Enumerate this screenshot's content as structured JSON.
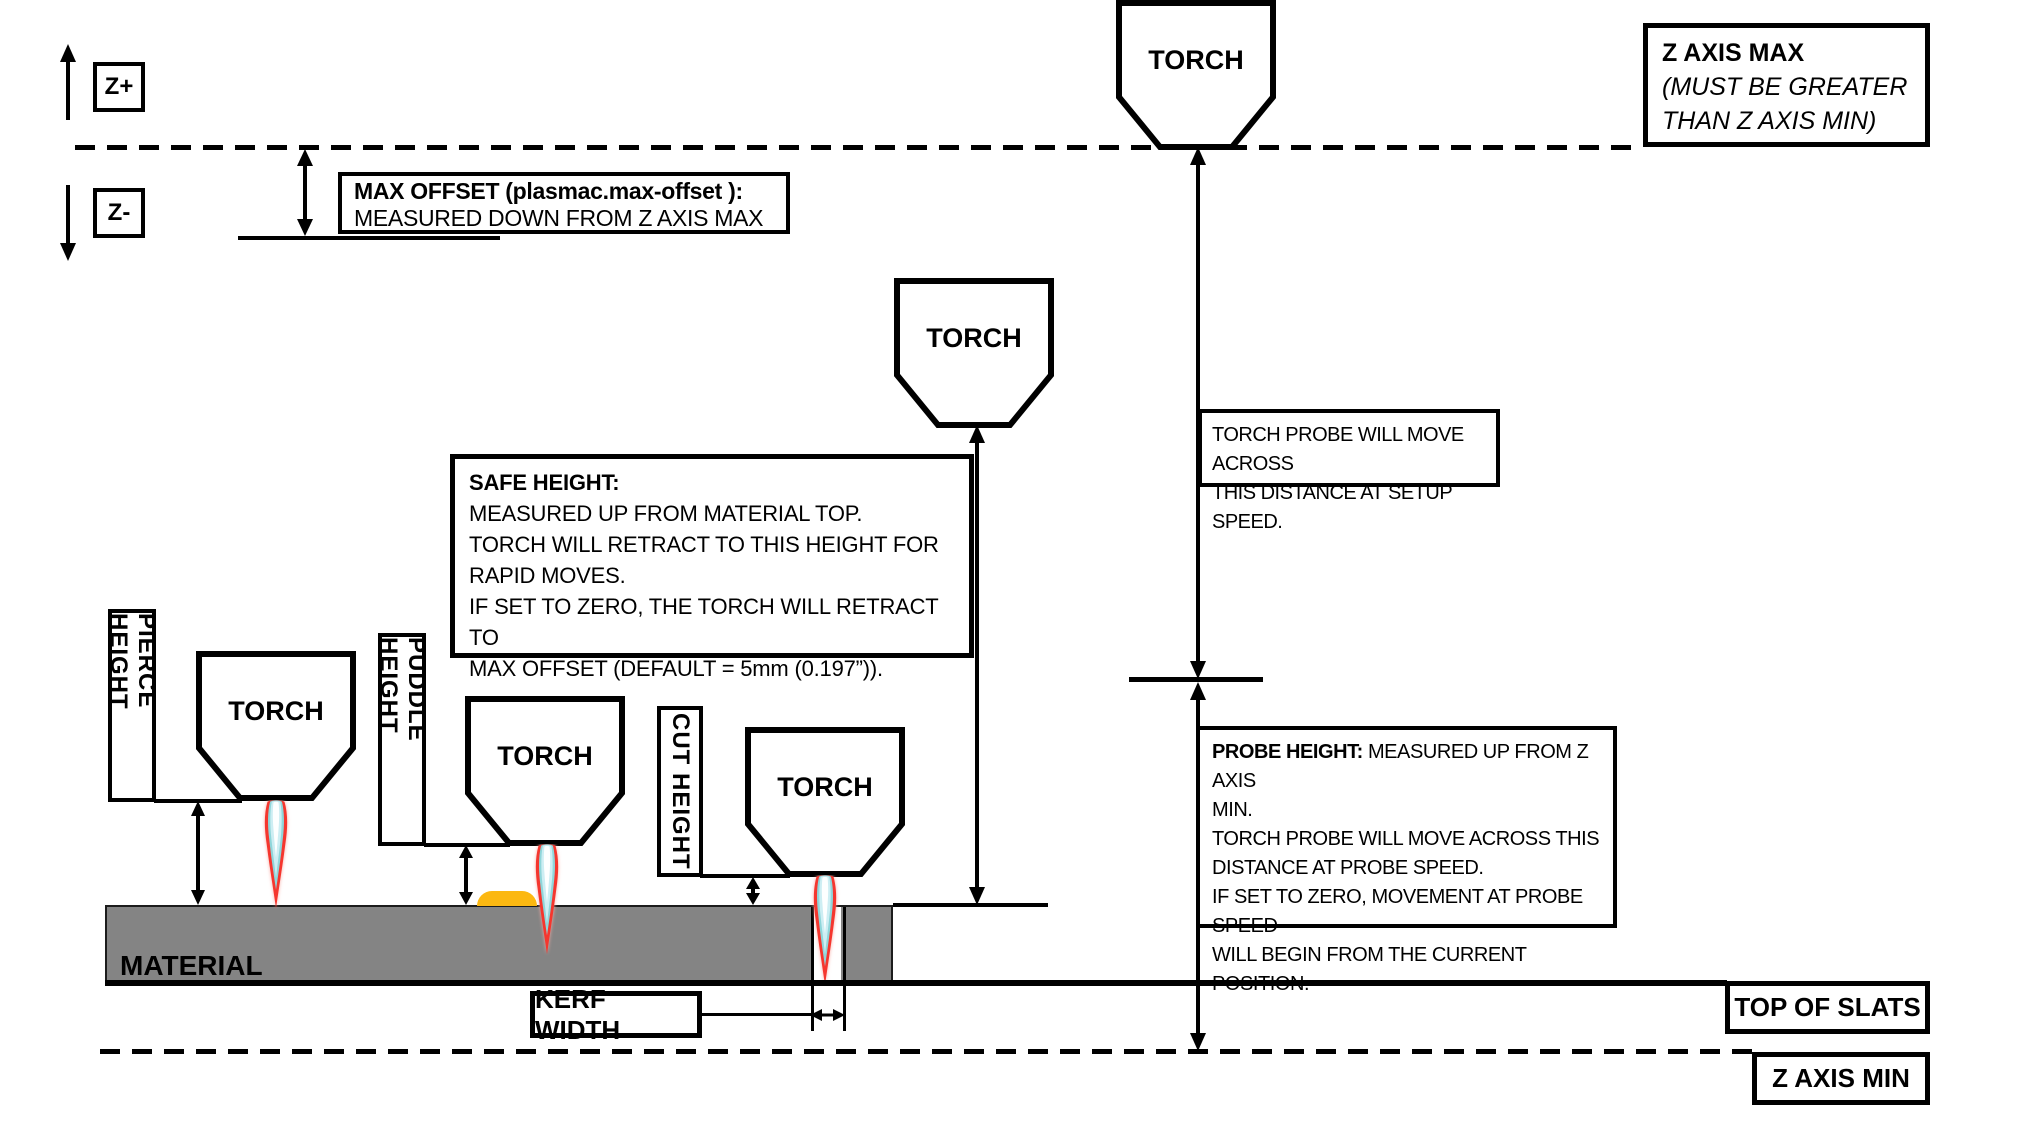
{
  "colors": {
    "ink": "#000000",
    "paper": "#ffffff",
    "material_gray": "#848484",
    "material_edge": "#1c1c1c",
    "flame_red": "#f5362e",
    "flame_glow": "#f9aba4",
    "flame_teal": "#8fd6da",
    "flame_blue": "#cdeef3",
    "flame_core": "#ffffff",
    "puddle_amber": "#fcb811"
  },
  "axis": {
    "z_plus": "Z+",
    "z_minus": "Z-"
  },
  "labels": {
    "torch": "TORCH",
    "material": "MATERIAL",
    "kerf_width": "KERF WIDTH",
    "top_of_slats": "TOP OF SLATS",
    "z_axis_min": "Z AXIS MIN",
    "pierce_height": "PIERCE HEIGHT",
    "puddle_height": "PUDDLE HEIGHT",
    "cut_height": "CUT HEIGHT"
  },
  "z_axis_max_box": {
    "line1": "Z AXIS MAX",
    "line2": "(MUST BE GREATER",
    "line3": "THAN Z AXIS MIN)"
  },
  "max_offset_box": {
    "line1": "MAX OFFSET (plasmac.max-offset ):",
    "line2": "MEASURED DOWN FROM Z AXIS MAX"
  },
  "torch_probe_box": {
    "line1": "TORCH PROBE WILL MOVE ACROSS",
    "line2": "THIS DISTANCE AT SETUP SPEED."
  },
  "safe_height_box": {
    "title": "SAFE HEIGHT:",
    "line2": "MEASURED UP FROM MATERIAL TOP.",
    "line3": "TORCH WILL RETRACT TO THIS HEIGHT FOR",
    "line4": "RAPID MOVES.",
    "line5": "IF SET TO ZERO, THE TORCH WILL RETRACT TO",
    "line6": "MAX OFFSET (DEFAULT = 5mm (0.197”))."
  },
  "probe_height_box": {
    "title": "PROBE HEIGHT:",
    "line1_rest": " MEASURED UP FROM Z AXIS",
    "line2": "MIN.",
    "line3": "TORCH PROBE WILL MOVE ACROSS THIS",
    "line4": "DISTANCE AT PROBE SPEED.",
    "line5": "IF SET TO ZERO,  MOVEMENT AT PROBE SPEED",
    "line6": "WILL BEGIN FROM THE CURRENT POSITION."
  }
}
